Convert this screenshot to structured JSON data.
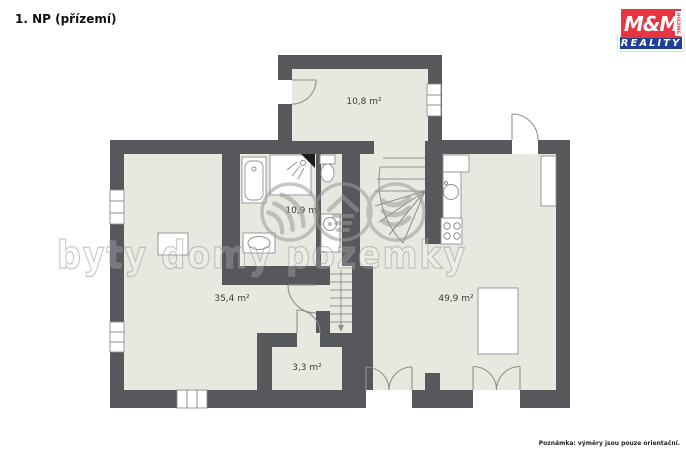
{
  "page": {
    "title": "1. NP (přízemí)",
    "note": "Poznámka: výměry jsou pouze orientační.",
    "background": "#ffffff"
  },
  "branding": {
    "name_top": "M&M",
    "holding": "HOLDING",
    "name_bottom": "REALITY",
    "red": "#e63440",
    "blue": "#1e3f94"
  },
  "watermark": {
    "text": "byty domy pozemky",
    "color": "#9b9b9b"
  },
  "plan": {
    "wall_color": "#56585c",
    "floor_color": "#e9e8e0",
    "outline_color": "#8f8f8f",
    "rooms": [
      {
        "name": "upper-room",
        "label": "10,8 m²"
      },
      {
        "name": "bathroom",
        "label": "10,9 m²"
      },
      {
        "name": "living-room",
        "label": "35,4 m²"
      },
      {
        "name": "entry-room",
        "label": "3,3 m²"
      },
      {
        "name": "main-room",
        "label": "49,9 m²"
      }
    ]
  }
}
